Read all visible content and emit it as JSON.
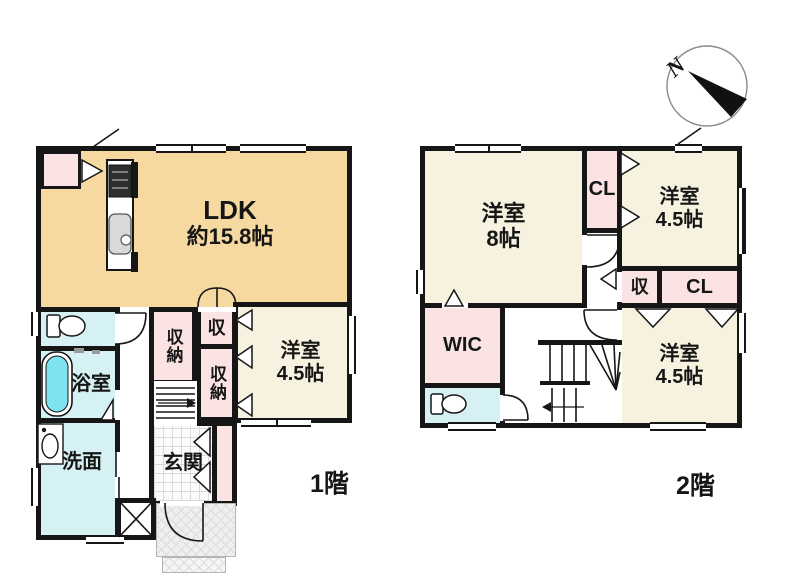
{
  "compass": {
    "north_label": "N"
  },
  "floor1": {
    "floor_label": "1階",
    "rooms": {
      "ldk": {
        "name": "LDK",
        "size": "約15.8帖"
      },
      "bedroom": {
        "name": "洋室",
        "size": "4.5帖"
      },
      "storage_a": "収納",
      "storage_b": "収納",
      "storage_small": "収",
      "bathroom": "浴室",
      "washroom": "洗面",
      "entrance": "玄関"
    }
  },
  "floor2": {
    "floor_label": "2階",
    "rooms": {
      "bedroom_8": {
        "name": "洋室",
        "size": "8帖"
      },
      "bedroom_ne": {
        "name": "洋室",
        "size": "4.5帖"
      },
      "bedroom_se": {
        "name": "洋室",
        "size": "4.5帖"
      },
      "closet_a": "CL",
      "closet_b": "CL",
      "storage_small": "収",
      "walk_in_closet": "WIC"
    }
  },
  "colors": {
    "ldk_fill": "#f5d9a0",
    "bedroom_fill": "#f7f1df",
    "closet_fill": "#fbe3e3",
    "wet_area_fill": "#d6f1f4",
    "bathtub_fill": "#7fe3ef",
    "wall": "#161616"
  }
}
